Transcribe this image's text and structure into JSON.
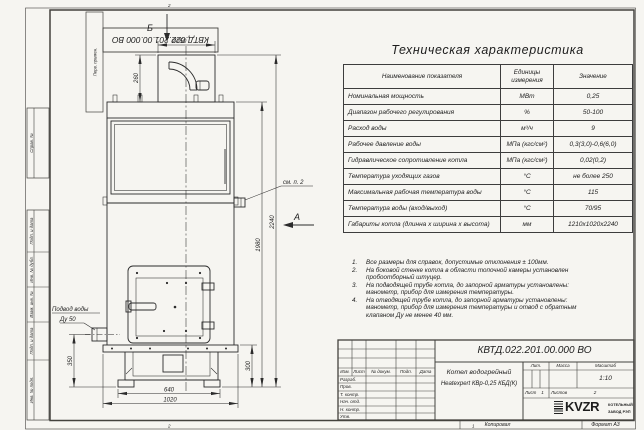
{
  "doc_number": "КВТД.022.201.00.000 ВО",
  "zones": {
    "top": "2",
    "bottom_left": "2",
    "bottom_mid": "1"
  },
  "footer": {
    "copied": "Копировал",
    "format": "Формат А3"
  },
  "margin_labels": {
    "perv": "Перв. примен.",
    "sprav": "Справ. №",
    "podp1": "Подп. и дата",
    "inv_dubl": "Инв. № дубл.",
    "vzam": "Взам. инв. №",
    "podp2": "Подп. и дата",
    "inv_podl": "Инв. № подл."
  },
  "drawing": {
    "view_top_label": "Б",
    "view_side_label": "А",
    "dims": {
      "chimney_diameter": "Ø250",
      "chimney_height": "260",
      "inlet_height": "350",
      "base_height": "300",
      "feet_span": "640",
      "width": "1020",
      "body_height": "1980",
      "total_height": "2240"
    },
    "callouts": {
      "see_note": "см. п. 2",
      "water_supply": "Подвод воды",
      "water_dn": "Ду 50"
    }
  },
  "spec_table": {
    "title": "Техническая характеристика",
    "headers": {
      "name": "Наименование показателя",
      "units": "Единицы измерения",
      "value": "Значение"
    },
    "rows": [
      {
        "name": "Номинальная мощность",
        "units": "МВт",
        "value": "0,25"
      },
      {
        "name": "Диапазон рабочего регулирования",
        "units": "%",
        "value": "50-100"
      },
      {
        "name": "Расход воды",
        "units": "м³/ч",
        "value": "9"
      },
      {
        "name": "Рабочее давление воды",
        "units": "МПа (кгс/см²)",
        "value": "0,3(3,0)-0,6(6,0)"
      },
      {
        "name": "Гидравлическое сопротивление котла",
        "units": "МПа (кгс/см²)",
        "value": "0,02(0,2)"
      },
      {
        "name": "Температура уходящих газов",
        "units": "°С",
        "value": "не более 250"
      },
      {
        "name": "Максимальная рабочая температура воды",
        "units": "°С",
        "value": "115"
      },
      {
        "name": "Температура воды (вход/выход)",
        "units": "°С",
        "value": "70/95"
      },
      {
        "name": "Габариты котла (длинна х ширина х высота)",
        "units": "мм",
        "value": "1210х1020х2240"
      }
    ]
  },
  "notes": {
    "items": [
      {
        "num": "1.",
        "text": "Все размеры для справок, допустимые отклонения ± 100мм."
      },
      {
        "num": "2.",
        "text": "На боковой стенке котла в области топочной камеры установлен пробоотборный штуцер."
      },
      {
        "num": "3.",
        "text": "На подводящей трубе котла, до запорной арматуры установлены: манометр, прибор для измерения температуры."
      },
      {
        "num": "4.",
        "text": "На отводящей трубе котла, до запорной арматуры установлены: манометр, прибор для измерения температуры и отвод с обратным клапаном Ду не менее 40 мм."
      }
    ]
  },
  "title_block": {
    "product_line1": "Котел водогрейный",
    "product_line2": "Heatexpert КВр-0,25 КБД(К)",
    "cols": {
      "izm": "Изм.",
      "list": "Лист",
      "n_dokum": "№ докум.",
      "podp": "Подп.",
      "data": "Дата"
    },
    "rows": {
      "razrab": "Разраб.",
      "prov": "Пров.",
      "t_kontr": "Т. контр.",
      "nach_otd": "Нач. отд.",
      "n_kontr": "Н. контр.",
      "utv": "Утв."
    },
    "lit_label": "Лит.",
    "massa_label": "Масса",
    "masshtab_label": "Масштаб",
    "scale": "1:10",
    "list_label": "Лист",
    "list_value": "1",
    "listov_label": "Листов",
    "listov_value": "2",
    "logo_text": "KVZR",
    "logo_sub1": "КОТЕЛЬНЫЙ",
    "logo_sub2": "ЗАВОД РЭП"
  }
}
